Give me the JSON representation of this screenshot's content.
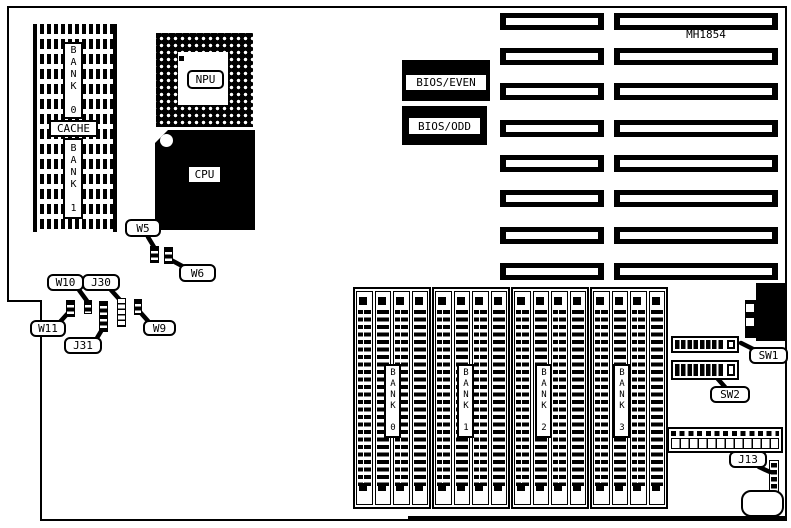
{
  "board": {
    "model": "MH1854"
  },
  "memory": {
    "cache_label": "CACHE",
    "cache_bank0": "BANK 0",
    "cache_bank1": "BANK 1",
    "simm_banks": [
      "BANK 0",
      "BANK 1",
      "BANK 2",
      "BANK 3"
    ]
  },
  "chips": {
    "npu": "NPU",
    "cpu": "CPU",
    "bios_even": "BIOS/EVEN",
    "bios_odd": "BIOS/ODD"
  },
  "callouts": {
    "w5": "W5",
    "w6": "W6",
    "w9": "W9",
    "w10": "W10",
    "w11": "W11",
    "j30": "J30",
    "j31": "J31",
    "j13": "J13",
    "sw1": "SW1",
    "sw2": "SW2"
  }
}
